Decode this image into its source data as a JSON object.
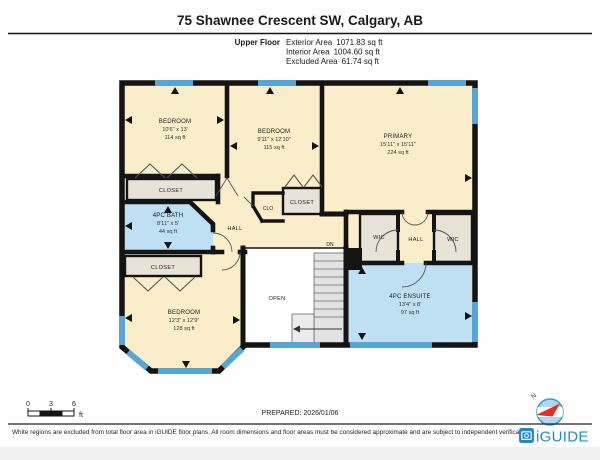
{
  "header": {
    "title": "75 Shawnee Crescent SW, Calgary, AB",
    "floor_label": "Upper Floor",
    "stats": [
      {
        "label": "Exterior Area",
        "value": "1071.83 sq ft"
      },
      {
        "label": "Interior Area",
        "value": "1004.60 sq ft"
      },
      {
        "label": "Excluded Area",
        "value": "61.74 sq ft"
      }
    ]
  },
  "rooms": [
    {
      "name": "BEDROOM",
      "dims": "10'6\" x 13'",
      "area": "114 sq ft"
    },
    {
      "name": "BEDROOM",
      "dims": "9'11\" x 12'10\"",
      "area": "115 sq ft"
    },
    {
      "name": "PRIMARY",
      "dims": "15'11\" x 15'11\"",
      "area": "224 sq ft"
    },
    {
      "name": "4PC BATH",
      "dims": "8'11\" x 5'",
      "area": "44 sq ft"
    },
    {
      "name": "BEDROOM",
      "dims": "12'3\" x 12'9\"",
      "area": "128 sq ft"
    },
    {
      "name": "4PC ENSUITE",
      "dims": "13'4\" x 8'",
      "area": "97 sq ft"
    }
  ],
  "labels": {
    "closet": "CLOSET",
    "clo": "CLO",
    "hall": "HALL",
    "wic": "WIC",
    "open": "OPEN",
    "dn": "DN"
  },
  "scale_bar": {
    "ticks": [
      "0",
      "3",
      "6"
    ],
    "unit": "ft"
  },
  "compass": {
    "north": "N"
  },
  "footer": {
    "prepared": "PREPARED: 2026/01/06",
    "disclaimer": "White regions are excluded from total floor area in iGUIDE floor plans. All room dimensions and floor areas must be considered approximate and are subject to independent verification.",
    "brand": "iGUIDE"
  },
  "colors": {
    "room_fill": "#FAEECA",
    "wet_room_fill": "#BFE0F3",
    "closet_fill": "#E7E3D9",
    "window": "#58A6D6",
    "wall": "#141414",
    "brand_blue": "#1D8DC8",
    "compass_red": "#E03020"
  }
}
